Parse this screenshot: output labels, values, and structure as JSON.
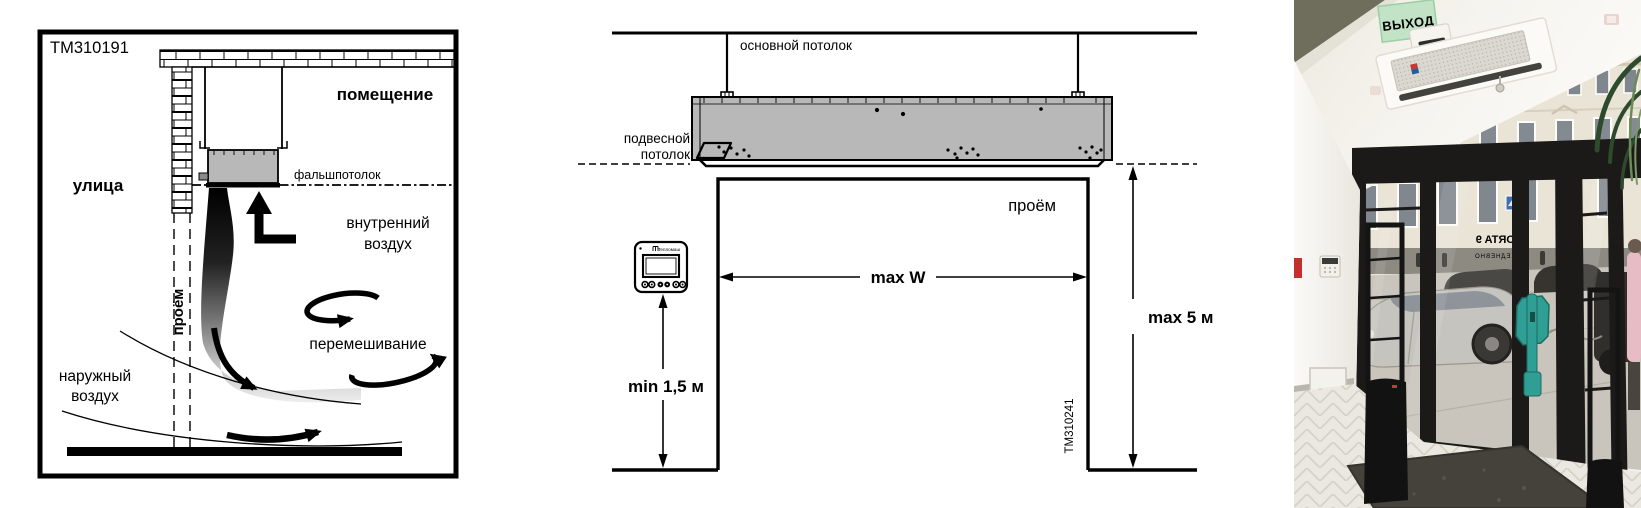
{
  "page": {
    "background": "#ffffff"
  },
  "left_diagram": {
    "figure_id": "TM310191",
    "labels": {
      "street": "улица",
      "room": "помещение",
      "false_ceiling": "фальшпотолок",
      "opening_vertical": "проём",
      "internal_air": [
        "внутренний",
        "воздух"
      ],
      "mixing": "перемешивание",
      "outside_air": [
        "наружный",
        "воздух"
      ]
    }
  },
  "middle_diagram": {
    "figure_id": "TM310241",
    "labels": {
      "main_ceiling": "основной потолок",
      "suspended_ceiling": [
        "подвесной",
        "потолок"
      ],
      "opening": "проём",
      "dim_max_width": "max W",
      "dim_max_height": "max 5 м",
      "dim_min_controller_height": "min 1,5 м"
    },
    "controller_brand": "Тепломаш"
  },
  "photo": {
    "exit_sign_text": "ВЫХОД",
    "glass_mirrored_text_line1": "PORTA 9",
    "glass_mirrored_text_line2": "ЕЖЕДНЕВНО"
  },
  "colors": {
    "diagram_line": "#111111",
    "unit_fill": "#b8b8b8",
    "exit_sign_green": "#28b44e",
    "exit_sign_glass": "#bfe3c4",
    "door_handle_teal": "#2f9e94",
    "door_frame_black": "#1b1a18",
    "facade_cream": "#e9e4d6",
    "floor_marble": "#ebe8e1",
    "mat_dark": "#45423c",
    "beam_olive": "#6f6d5c"
  }
}
